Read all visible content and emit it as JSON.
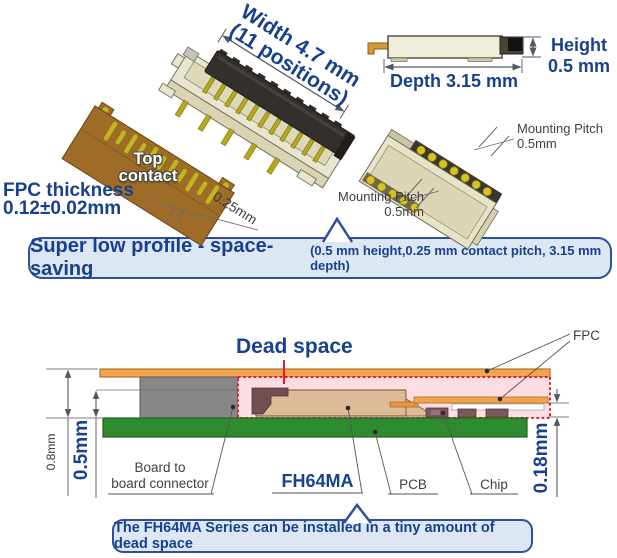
{
  "illustration": {
    "width_line1": "Width 4.7 mm",
    "width_line2": "(11 positions)",
    "fpc_thickness_line1": "FPC thickness",
    "fpc_thickness_line2": "0.12±0.02mm",
    "top_contact_line1": "Top",
    "top_contact_line2": "contact",
    "contact_pitch": "0.25mm",
    "height_line1": "Height",
    "height_line2": "0.5 mm",
    "depth": "Depth 3.15 mm",
    "mounting_pitch_top_line1": "Mounting Pitch",
    "mounting_pitch_top_line2": "0.5mm",
    "mounting_pitch_bottom_line1": "Mounting Pitch",
    "mounting_pitch_bottom_line2": "0.5mm"
  },
  "feature_banner": {
    "main": "Super low profile - space-saving",
    "detail": "(0.5 mm height,0.25 mm contact pitch, 3.15 mm depth)"
  },
  "cross_section": {
    "dead_space": "Dead space",
    "fpc": "FPC",
    "total_height": "0.8mm",
    "connector_height": "0.5mm",
    "gap_height": "0.18mm",
    "board_to_board_line1": "Board to",
    "board_to_board_line2": "board connector",
    "series_name": "FH64MA",
    "pcb": "PCB",
    "chip": "Chip"
  },
  "bottom_banner": {
    "text": "The FH64MA Series can be installed in a tiny amount of dead space"
  },
  "colors": {
    "accent_blue": "#17418e",
    "banner_bg": "#dce7f3",
    "banner_border": "#2d4f9e",
    "dead_space_red": "#e8192c",
    "fpc_orange": "#f2a44e",
    "pcb_green": "#2e8b30",
    "dead_space_pink": "#fcdde3",
    "connector_tan": "#debb97",
    "b2b_gray": "#878787",
    "contact_gold": "#c2b422",
    "fpc_brown": "#9e6c26",
    "body_cream": "#e9e6cf",
    "actuator_dark": "#332f2a"
  }
}
